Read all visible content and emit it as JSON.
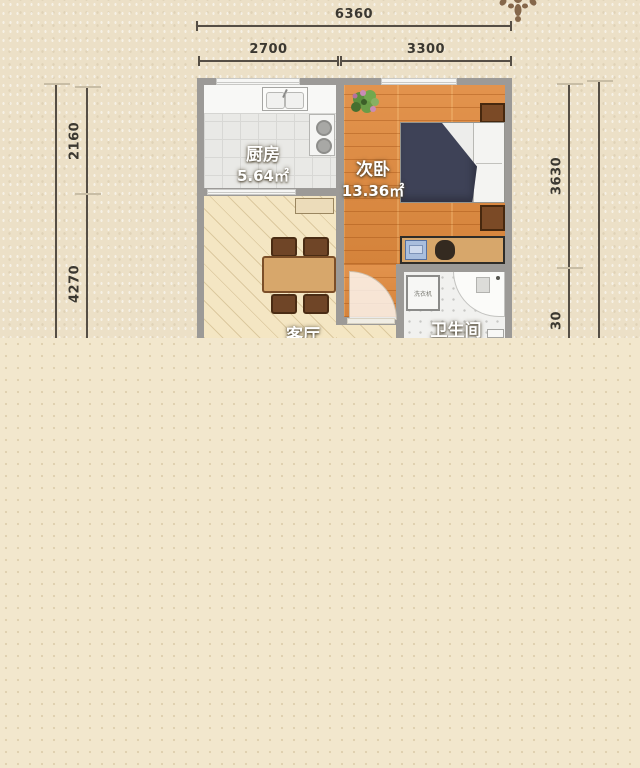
{
  "dimensions": {
    "top_total": "6360",
    "top_left": "2700",
    "top_right": "3300",
    "left_upper": "2160",
    "left_lower": "4270",
    "right_upper": "3630",
    "right_lower": "30"
  },
  "rooms": {
    "kitchen": {
      "name": "厨房",
      "area": "5.64㎡"
    },
    "bedroom": {
      "name": "次卧",
      "area": "13.36㎡"
    },
    "living": {
      "name": "客厅"
    },
    "bathroom": {
      "name": "卫生间"
    },
    "washer_label": "洗衣机"
  },
  "colors": {
    "bg_page": "#f2e7cd",
    "bg_plan": "#ece0c7",
    "wall": "#9c9a97",
    "dim_line": "#554e45",
    "dim_text": "#3b3831",
    "kitchen_floor": "#e9e9e6",
    "bedroom_floor": "#e08a3e",
    "living_floor": "#f4e6c3",
    "bath_floor": "#f1f1ef",
    "bed_duvet": "#3e4257",
    "wood": "#d7a76b",
    "wood_dark": "#6f4527"
  }
}
